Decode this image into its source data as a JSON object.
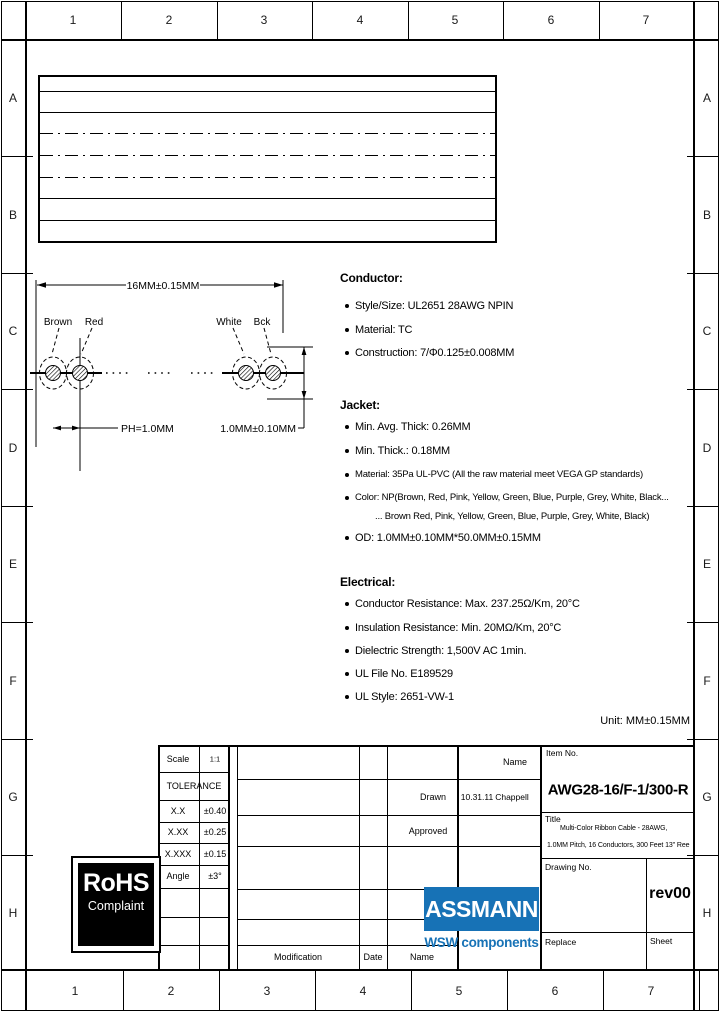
{
  "frame": {
    "columns": [
      "1",
      "2",
      "3",
      "4",
      "5",
      "6",
      "7"
    ],
    "rows": [
      "A",
      "B",
      "C",
      "D",
      "E",
      "F",
      "G",
      "H"
    ]
  },
  "cross_section": {
    "width_dim": "16MM±0.15MM",
    "pitch_dim": "PH=1.0MM",
    "od_dim": "1.0MM±0.10MM",
    "wire_labels": [
      "Brown",
      "Red",
      "White",
      "Bck"
    ]
  },
  "specs": {
    "conductor": {
      "title": "Conductor:",
      "items": [
        "Style/Size: UL2651 28AWG NPIN",
        "Material: TC",
        "Construction: 7/Φ0.125±0.008MM"
      ]
    },
    "jacket": {
      "title": "Jacket:",
      "items": [
        "Min. Avg. Thick: 0.26MM",
        "Min. Thick.: 0.18MM",
        "Material: 35Pa UL-PVC (All the raw material meet VEGA GP standards)",
        "Color: NP(Brown, Red, Pink, Yellow, Green, Blue, Purple, Grey, White, Black...",
        "... Brown Red, Pink, Yellow, Green, Blue, Purple, Grey, White, Black)",
        "OD: 1.0MM±0.10MM*50.0MM±0.15MM"
      ]
    },
    "electrical": {
      "title": "Electrical:",
      "items": [
        "Conductor Resistance: Max. 237.25Ω/Km, 20°C",
        "Insulation Resistance: Min. 20MΩ/Km, 20°C",
        "Dielectric Strength: 1,500V AC 1min.",
        "UL File No. E189529",
        "UL Style: 2651-VW-1"
      ]
    },
    "unit_note": "Unit: MM±0.15MM"
  },
  "title_block": {
    "scale_label": "Scale",
    "scale_value": "1:1",
    "tolerance_label": "TOLERANCE",
    "tol_rows": [
      {
        "label": "X.X",
        "value": "±0.40"
      },
      {
        "label": "X.XX",
        "value": "±0.25"
      },
      {
        "label": "X.XXX",
        "value": "±0.15"
      },
      {
        "label": "Angle",
        "value": "±3°"
      }
    ],
    "modification_label": "Modification",
    "date_label": "Date",
    "name_label": "Name",
    "name_header": "Name",
    "drawn_label": "Drawn",
    "drawn_date": "10.31.11",
    "drawn_name": "Chappell",
    "approved_label": "Approved",
    "item_no_label": "Item No.",
    "item_no": "AWG28-16/F-1/300-R",
    "title_label": "Title",
    "title_line1": "Multi-Color Ribbon Cable - 28AWG,",
    "title_line2": "1.0MM Pitch, 16 Conductors, 300 Feet 13\" Ree",
    "drawing_no_label": "Drawing No.",
    "revision": "rev00",
    "replace_label": "Replace",
    "sheet_label": "Sheet"
  },
  "logos": {
    "rohs_title": "RoHS",
    "rohs_subtitle": "Complaint",
    "assmann": "ASSMANN",
    "assmann_sub": "WSW components",
    "assmann_blue": "#1772b6"
  }
}
